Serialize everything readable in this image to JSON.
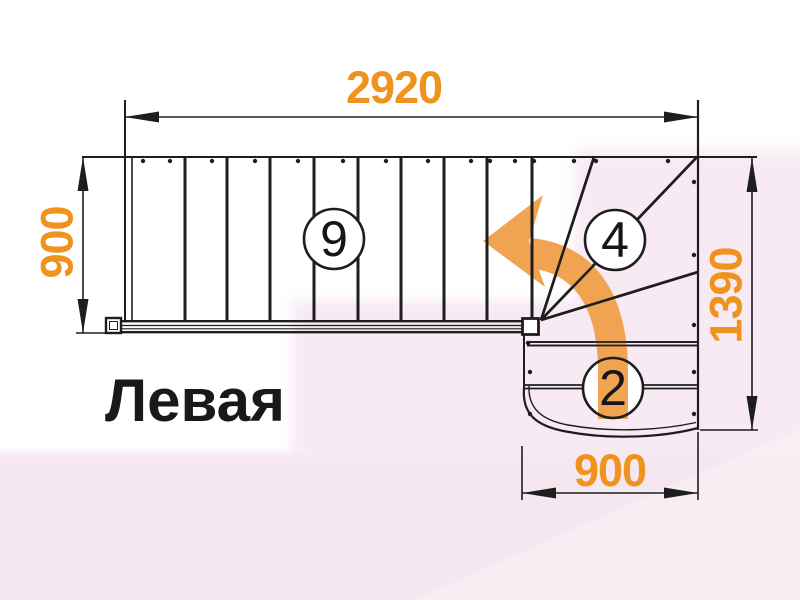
{
  "title": "Левая",
  "dimensions": {
    "top": "2920",
    "left": "900",
    "right": "1390",
    "bottom": "900"
  },
  "steps": {
    "straight_flight_count": "9",
    "winder_count": "4",
    "bottom_flight_count": "2"
  },
  "colors": {
    "dimension_text": "#f0921e",
    "direction_arrow": "#f0a452",
    "drawing_line": "#1e1e1e",
    "background_pink": "#f7eaf3"
  }
}
